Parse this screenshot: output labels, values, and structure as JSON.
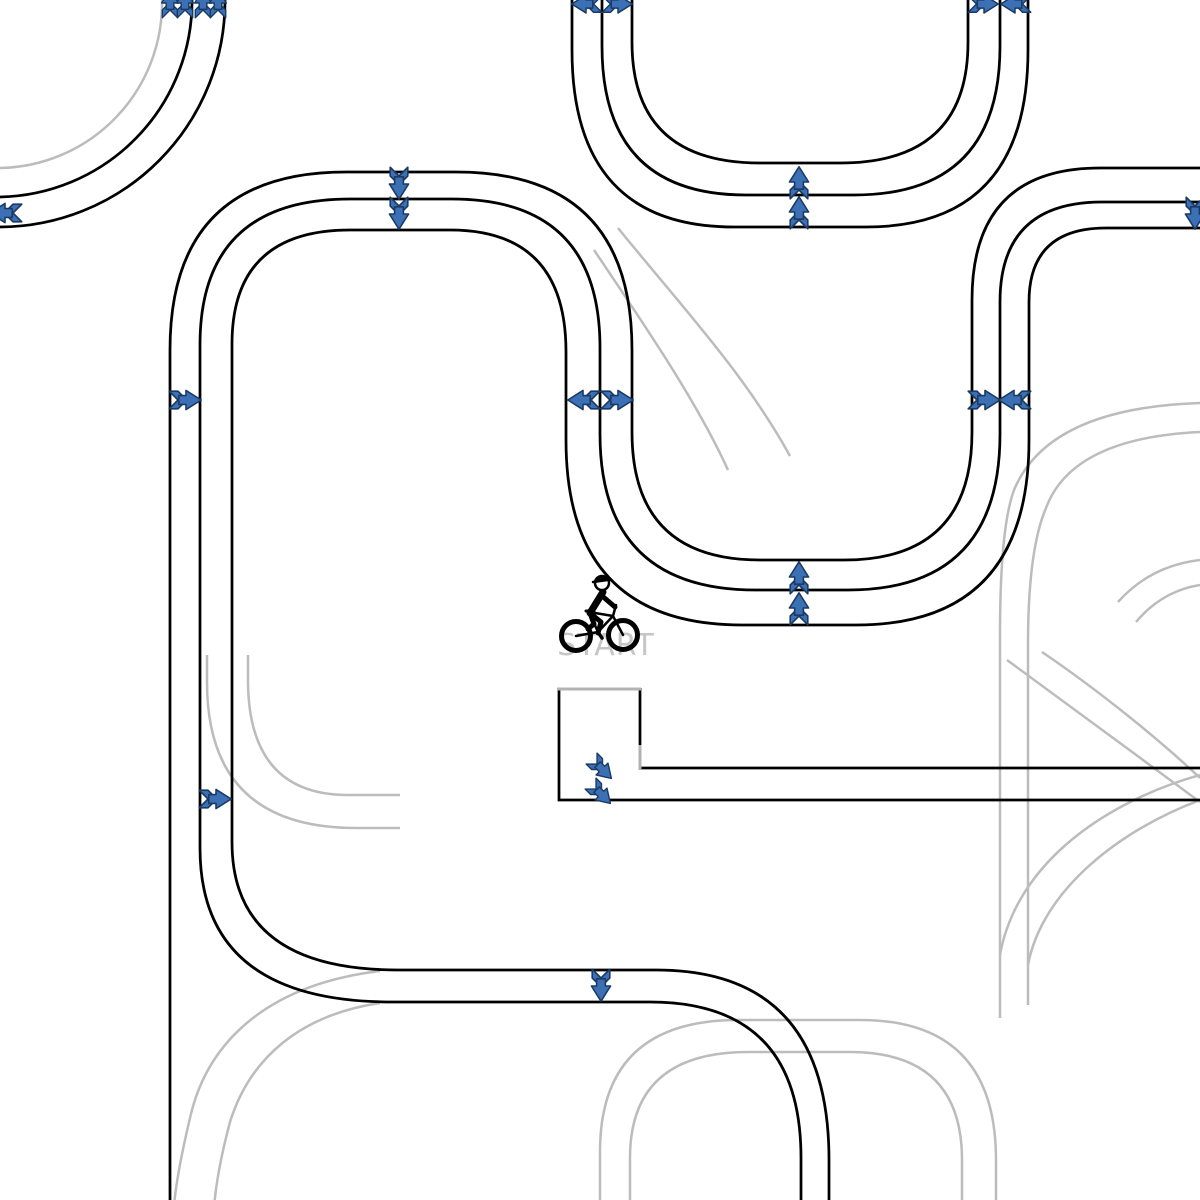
{
  "scene": {
    "width": 1200,
    "height": 1200,
    "background": "#ffffff"
  },
  "labels": {
    "start": "START",
    "start_pos": {
      "x": 606,
      "y": 655
    }
  },
  "colors": {
    "track": "#000000",
    "ghost": "#bcbcbc",
    "platform_gray": "#b3b3b3",
    "arrow_fill": "#3b70b5",
    "arrow_stroke": "#1a3a63",
    "start_text": "#c6c6c6"
  },
  "tracks": {
    "black": [
      "M 0 197 A 196 196 0 0 0 192 0",
      "M 0 227 A 226 226 0 0 0 225 0",
      "M 632 0 L 632 42 Q 632 163 760 163 L 840 163 Q 968 163 968 42 L 968 0",
      "M 602 0 L 602 46 Q 602 195 746 195 L 854 195 Q 1000 195 1000 46 L 1000 0",
      "M 572 0 L 572 50 Q 572 227 734 227 L 866 227 Q 1028 227 1028 50 L 1028 0",
      "M 170 1200 L 170 350 Q 170 172 346 172 L 456 172 Q 632 172 632 350 L 632 432 Q 632 560 760 560 L 844 560 Q 972 560 972 432 L 972 300 Q 972 168 1100 168 L 1200 168",
      "M 801 1200 L 801 1158 Q 801 1002 650 1002 L 392 1002 Q 200 1002 200 848 L 200 345 Q 200 199 350 199 L 452 199 Q 600 199 600 348 L 600 434 Q 600 590 756 590 L 848 590 Q 1000 590 1000 434 L 1000 302 Q 1000 202 1102 202 L 1200 202",
      "M 829 1200 L 829 1160 Q 829 970 656 970 L 398 970 Q 232 970 232 842 L 232 344 Q 232 230 350 230 L 450 230 Q 566 230 566 352 L 566 440 Q 566 625 742 625 L 856 625 Q 1029 625 1029 440 L 1029 302 Q 1029 228 1106 228 L 1200 228",
      "M 559 688 L 559 800 L 1200 800",
      "M 640 688 L 640 747",
      "M 640 768 L 1200 768"
    ],
    "platform_gray": [
      "M 557 689 L 641 689",
      "M 640 745 L 640 770"
    ],
    "ghost": [
      "M 0 168 A 165 165 0 0 0 162 0",
      "M 618 228 C 676 300 744 372 790 456",
      "M 594 250 C 648 330 698 404 728 470",
      "M 1200 403 Q 1048 408 1014 490 Q 1000 528 1000 635 L 1000 1018",
      "M 1200 432 Q 1072 438 1046 508 Q 1028 550 1028 645 L 1028 1005",
      "M 1200 560 Q 1150 566 1118 602",
      "M 1200 585 Q 1162 591 1136 622",
      "M 1007 660 C 1062 700 1140 758 1200 802",
      "M 1042 652 C 1098 690 1160 740 1200 778",
      "M 1000 955 C 1015 870 1095 805 1200 775",
      "M 1028 965 C 1042 890 1120 830 1200 800",
      "M 600 1200 L 600 1152 Q 600 1020 738 1020 L 860 1020 Q 996 1020 996 1160 L 996 1200",
      "M 630 1200 L 630 1158 Q 630 1052 748 1052 L 850 1052 Q 962 1052 962 1160 L 962 1200",
      "M 207 655 L 207 682 Q 207 828 356 828 L 400 828",
      "M 248 655 L 248 680 Q 248 795 348 795 L 400 795",
      "M 380 971 C 272 984 208 1038 190 1118 C 181 1156 176 1182 174 1206",
      "M 380 1003 C 300 1015 250 1058 230 1122 C 222 1152 216 1182 214 1208"
    ]
  },
  "arrows": [
    {
      "x": 170,
      "y": 3,
      "dir": "up",
      "scale": 0.7
    },
    {
      "x": 185,
      "y": 3,
      "dir": "up",
      "scale": 0.7
    },
    {
      "x": 203,
      "y": 3,
      "dir": "up",
      "scale": 0.7
    },
    {
      "x": 218,
      "y": 3,
      "dir": "up",
      "scale": 0.7
    },
    {
      "x": 5,
      "y": 213,
      "dir": "left",
      "scale": 0.8
    },
    {
      "x": 586,
      "y": 4,
      "dir": "left",
      "scale": 0.75
    },
    {
      "x": 618,
      "y": 4,
      "dir": "right",
      "scale": 0.75
    },
    {
      "x": 984,
      "y": 4,
      "dir": "right",
      "scale": 0.75
    },
    {
      "x": 1015,
      "y": 4,
      "dir": "left",
      "scale": 0.75
    },
    {
      "x": 399,
      "y": 184,
      "dir": "down",
      "scale": 0.8
    },
    {
      "x": 399,
      "y": 214,
      "dir": "down",
      "scale": 0.8
    },
    {
      "x": 799,
      "y": 182,
      "dir": "up",
      "scale": 0.8
    },
    {
      "x": 799,
      "y": 212,
      "dir": "up",
      "scale": 0.8
    },
    {
      "x": 186,
      "y": 400,
      "dir": "right",
      "scale": 0.8
    },
    {
      "x": 583,
      "y": 400,
      "dir": "left",
      "scale": 0.8
    },
    {
      "x": 618,
      "y": 400,
      "dir": "right",
      "scale": 0.8
    },
    {
      "x": 985,
      "y": 400,
      "dir": "right",
      "scale": 0.8
    },
    {
      "x": 1014,
      "y": 400,
      "dir": "left",
      "scale": 0.8
    },
    {
      "x": 1195,
      "y": 214,
      "dir": "down",
      "scale": 0.8
    },
    {
      "x": 799,
      "y": 577,
      "dir": "up",
      "scale": 0.8
    },
    {
      "x": 799,
      "y": 608,
      "dir": "up",
      "scale": 0.8
    },
    {
      "x": 216,
      "y": 799,
      "dir": "right",
      "scale": 0.8
    },
    {
      "x": 602,
      "y": 769,
      "dir": "down-right",
      "scale": 0.7
    },
    {
      "x": 601,
      "y": 794,
      "dir": "down-right",
      "scale": 0.7
    },
    {
      "x": 601,
      "y": 986,
      "dir": "down",
      "scale": 0.8
    }
  ],
  "rider": {
    "x": 600,
    "y": 611
  }
}
